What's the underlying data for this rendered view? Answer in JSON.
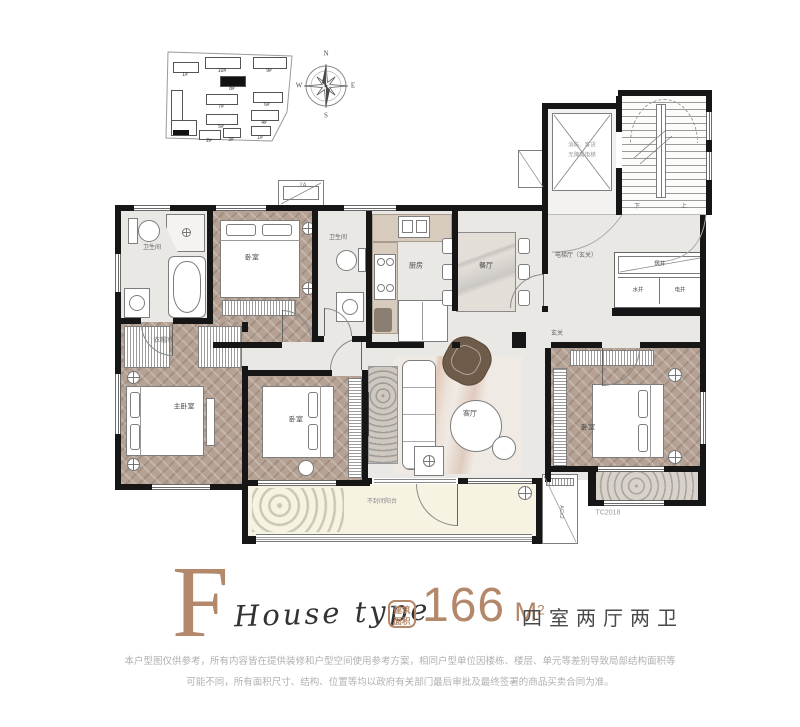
{
  "colors": {
    "accent": "#b4886a",
    "wall": "#161616",
    "wood": "#b5a294"
  },
  "site_plan": {
    "buildings": [
      {
        "label": "1#"
      },
      {
        "label": "10#"
      },
      {
        "label": "9#"
      },
      {
        "label": "8#"
      },
      {
        "label": "7#"
      },
      {
        "label": "6#"
      },
      {
        "label": "5#"
      },
      {
        "label": "4#"
      },
      {
        "label": "3#"
      },
      {
        "label": "2#"
      },
      {
        "label": "1#"
      }
    ]
  },
  "compass": {
    "north": "N",
    "south": "S",
    "east": "E",
    "west": "W"
  },
  "plan": {
    "rooms": {
      "bath1": "卫生间",
      "bedroom_top": "卧室",
      "bath2": "卫生间",
      "kitchen": "厨房",
      "dining": "餐厅",
      "elevator_hall": "电梯厅（玄关）",
      "elevator_line1": "消防、客货",
      "elevator_line2": "无障碍电梯",
      "stair_down": "下",
      "stair_up": "上",
      "wind_shaft": "风井",
      "water_shaft": "水井",
      "elec_shaft": "电井",
      "closet": "衣帽间",
      "master_bedroom": "主卧室",
      "bedroom_mid": "卧室",
      "bedroom_right": "卧室",
      "living": "客厅",
      "foyer": "玄关",
      "balcony": "不封闭阳台"
    },
    "tags": {
      "bay_window": "2A",
      "ac": "ACx2",
      "corner": "TC2018"
    }
  },
  "info": {
    "letter": "F",
    "subtitle": "House type",
    "badge_line1": "建筑",
    "badge_line2": "面积",
    "area_value": "166",
    "area_unit": "M",
    "area_sup": "2",
    "layout": "四室两厅两卫"
  },
  "disclaimer": {
    "line1": "本户型图仅供参考，所有内容皆在提供装修和户型空间使用参考方案，相同户型单位因楼栋、楼层、单元等差别导致局部结构面积等",
    "line2": "可能不同，所有面积尺寸、结构、位置等均以政府有关部门最后审批及最终签署的商品买卖合同为准。"
  }
}
